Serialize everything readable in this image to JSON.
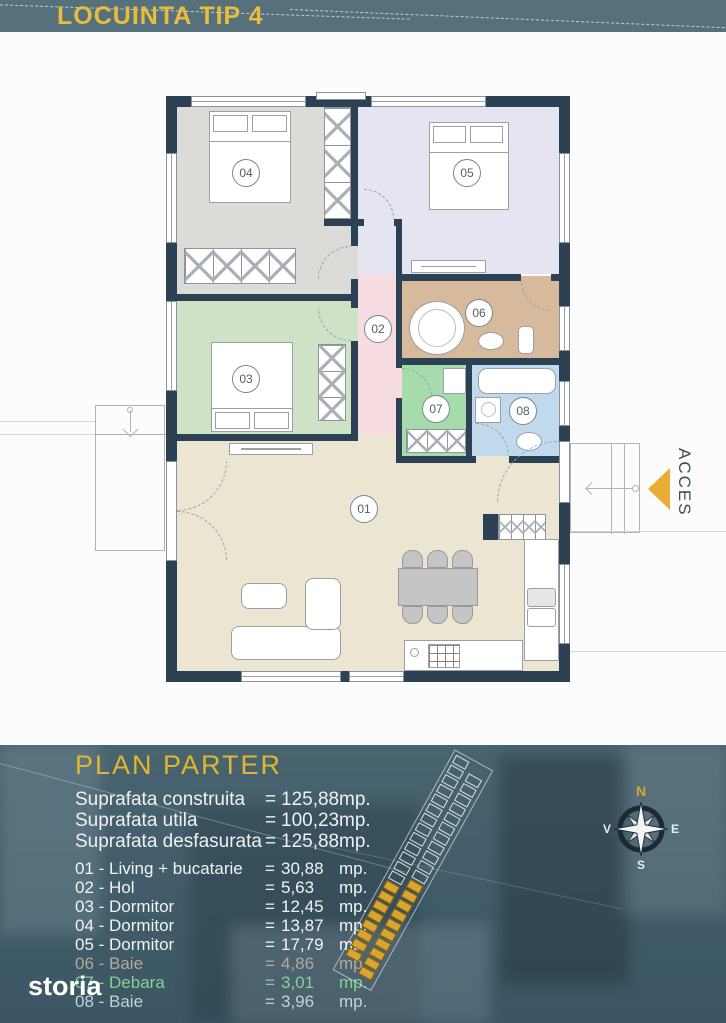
{
  "header": {
    "title": "LOCUINTA TIP 4"
  },
  "plan": {
    "access_label": "ACCES",
    "rooms": [
      {
        "label": "01",
        "fill": "#ece5d1"
      },
      {
        "label": "02",
        "fill": "#f6dce0"
      },
      {
        "label": "03",
        "fill": "#d0e2c6"
      },
      {
        "label": "04",
        "fill": "#dbdbd8"
      },
      {
        "label": "05",
        "fill": "#e5e5f2"
      },
      {
        "label": "06",
        "fill": "#d7b99c"
      },
      {
        "label": "07",
        "fill": "#a6dcac"
      },
      {
        "label": "08",
        "fill": "#c0d9ec"
      }
    ]
  },
  "details": {
    "title": "PLAN PARTER",
    "summary": [
      {
        "label": "Suprafata construita",
        "eq": "=",
        "value": "125,88",
        "unit": "mp."
      },
      {
        "label": "Suprafata utila",
        "eq": "=",
        "value": "100,23",
        "unit": "mp."
      },
      {
        "label": "Suprafata desfasurata",
        "eq": "=",
        "value": "125,88",
        "unit": "mp."
      }
    ],
    "legend": [
      {
        "label": "01 - Living + bucatarie",
        "eq": "=",
        "value": "30,88",
        "unit": "mp.",
        "color": "#f0f3f4"
      },
      {
        "label": "02 - Hol",
        "eq": "=",
        "value": "5,63",
        "unit": "mp.",
        "color": "#f0f3f4"
      },
      {
        "label": "03 - Dormitor",
        "eq": "=",
        "value": "12,45",
        "unit": "mp.",
        "color": "#f0f3f4"
      },
      {
        "label": "04 - Dormitor",
        "eq": "=",
        "value": "13,87",
        "unit": "mp.",
        "color": "#f0f3f4"
      },
      {
        "label": "05 - Dormitor",
        "eq": "=",
        "value": "17,79",
        "unit": "mp.",
        "color": "#f0f3f4"
      },
      {
        "label": "06 - Baie",
        "eq": "=",
        "value": "4,86",
        "unit": "mp.",
        "color": "#b2a99b"
      },
      {
        "label": "07 - Debara",
        "eq": "=",
        "value": "3,01",
        "unit": "mp.",
        "color": "#84d098"
      },
      {
        "label": "08 - Baie",
        "eq": "=",
        "value": "3,96",
        "unit": "mp.",
        "color": "#c2d2db"
      }
    ]
  },
  "compass": {
    "north": "N",
    "east": "E",
    "south": "S",
    "west": "V"
  },
  "watermark": "storia",
  "colors": {
    "accent_yellow": "#e8b83a",
    "header_bg": "#56707c",
    "wall": "#2c4254",
    "panel_bg": "#435f6d"
  }
}
